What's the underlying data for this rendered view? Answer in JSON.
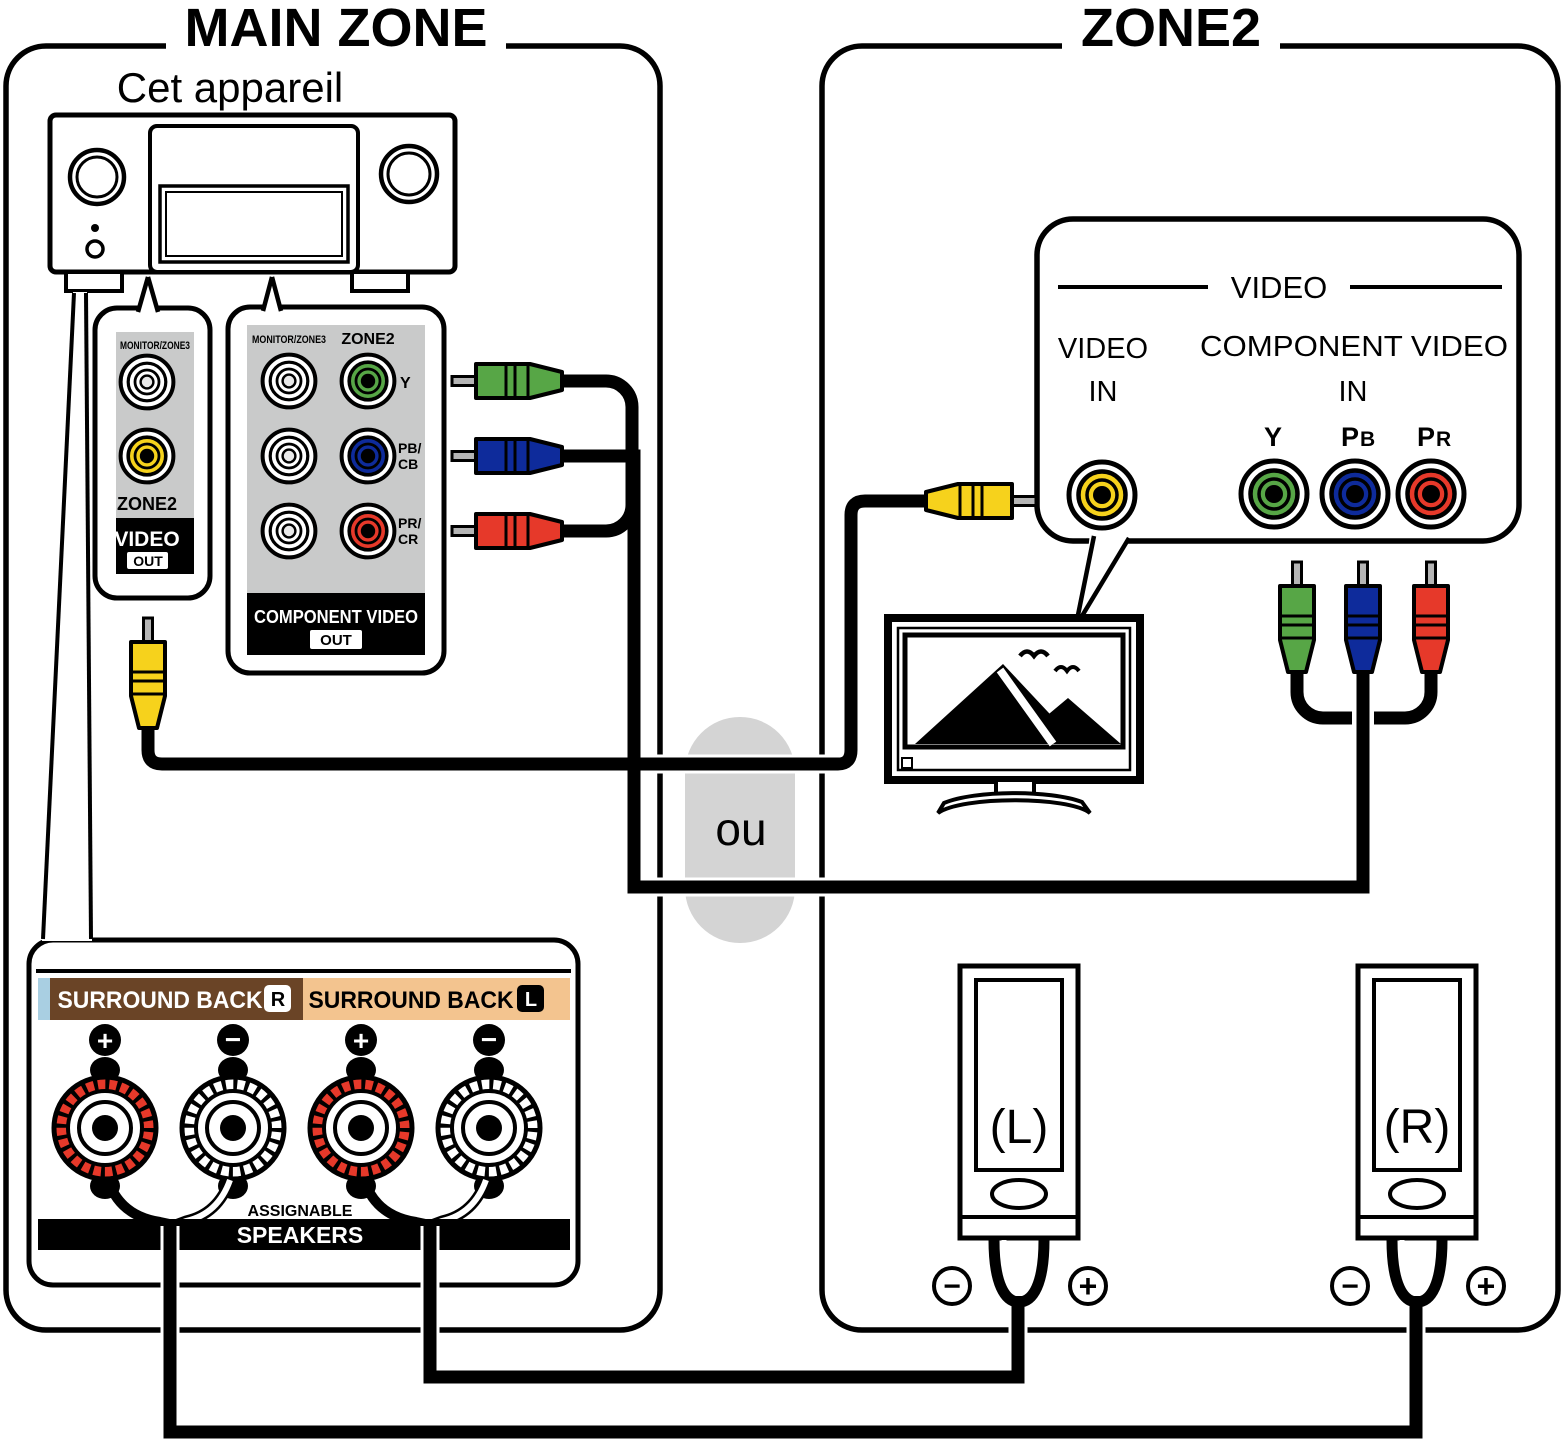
{
  "or_label": "ou",
  "colors": {
    "yellow": "#f6d21c",
    "green": "#57a646",
    "blue": "#0e2b9b",
    "red": "#e6392a",
    "panel_gray": "#c9caca",
    "capsule_gray": "#d4d4d4",
    "brown": "#6a4426",
    "tan": "#f3c48f",
    "sliver_blue": "#a9cfe2",
    "pin_silver": "#b5b5b5"
  },
  "main_zone": {
    "title": "MAIN ZONE",
    "device_label": "Cet appareil",
    "video_out_panel": {
      "header": "MONITOR/ZONE3",
      "zone2_label": "ZONE2",
      "video_label": "VIDEO",
      "out_label": "OUT"
    },
    "component_out_panel": {
      "header_left": "MONITOR/ZONE3",
      "header_right": "ZONE2",
      "row_labels": [
        {
          "l1": "Y",
          "l2": ""
        },
        {
          "l1": "PB/",
          "l2": "CB"
        },
        {
          "l1": "PR/",
          "l2": "CR"
        }
      ],
      "footer": "COMPONENT VIDEO",
      "out_label": "OUT"
    },
    "speaker_panel": {
      "surround_back_r": "SURROUND BACK",
      "badge_r": "R",
      "surround_back_l": "SURROUND BACK",
      "badge_l": "L",
      "plus": "+",
      "minus": "−",
      "assignable": "ASSIGNABLE",
      "speakers": "SPEAKERS"
    }
  },
  "zone2": {
    "title": "ZONE2",
    "video_bubble": {
      "header": "VIDEO",
      "video_in_l1": "VIDEO",
      "video_in_l2": "IN",
      "component_l1": "COMPONENT VIDEO",
      "component_l2": "IN",
      "y_label": "Y",
      "pb_main": "P",
      "pb_sub": "B",
      "pr_main": "P",
      "pr_sub": "R"
    },
    "speaker_left_label": "(L)",
    "speaker_right_label": "(R)",
    "minus": "−",
    "plus": "+"
  }
}
